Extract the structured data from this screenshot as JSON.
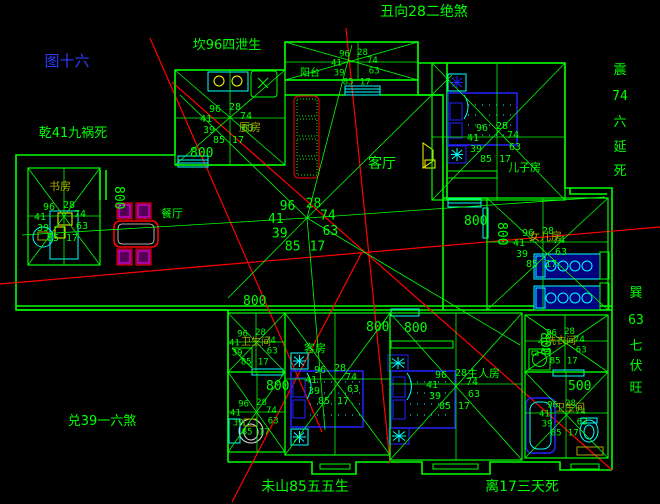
{
  "figure": {
    "label": "图十六",
    "color": "#2b3cff"
  },
  "compass": {
    "top": "丑向28二绝煞",
    "north": "坎96四泄生",
    "northwest": "乾41九祸死",
    "west": "兑39一六煞",
    "mountain": "未山85五五生",
    "south": "离17三天死",
    "east_chars": [
      "震",
      "74",
      "六",
      "延",
      "死"
    ],
    "southeast_chars": [
      "巽",
      "63",
      "七",
      "伏",
      "旺"
    ]
  },
  "stars": {
    "n1": "96",
    "n2": "28",
    "w": "41",
    "e": "74",
    "sw": "39",
    "se": "63",
    "s1": "85",
    "s2": "17"
  },
  "rooms": [
    {
      "id": "kitchen",
      "label": "厨房",
      "label_color": "olive",
      "rect": [
        175,
        70,
        110,
        95
      ],
      "center": [
        230,
        118
      ],
      "label_xy": [
        239,
        131
      ],
      "fs": 10
    },
    {
      "id": "balcony",
      "label": "阳台",
      "label_color": "green",
      "rect": [
        285,
        42,
        133,
        38
      ],
      "center": [
        358,
        62
      ],
      "label_xy": [
        300,
        76
      ],
      "fs": 9
    },
    {
      "id": "living",
      "label": "客厅",
      "label_color": "green",
      "center": [
        307,
        218
      ],
      "rays": [
        [
          180,
          95
        ],
        [
          352,
          45
        ],
        [
          452,
          75
        ],
        [
          605,
          197
        ],
        [
          520,
          345
        ],
        [
          325,
          430
        ],
        [
          228,
          298
        ],
        [
          22,
          235
        ]
      ],
      "label_xy": [
        368,
        168
      ],
      "fs": 13
    },
    {
      "id": "dining",
      "label": "餐厅",
      "label_color": "green",
      "label_xy": [
        161,
        217
      ],
      "fs": 10
    },
    {
      "id": "study",
      "label": "书房",
      "label_color": "olive",
      "rect": [
        28,
        168,
        72,
        97
      ],
      "center": [
        64,
        216
      ],
      "label_xy": [
        49,
        190
      ],
      "fs": 10
    },
    {
      "id": "son",
      "label": "儿子房",
      "label_color": "green",
      "rect": [
        432,
        63,
        133,
        137
      ],
      "center": [
        497,
        137
      ],
      "label_xy": [
        508,
        171
      ],
      "fs": 10
    },
    {
      "id": "daughter",
      "label": "女儿房",
      "label_color": "olive",
      "rect": [
        487,
        198,
        121,
        112
      ],
      "center": [
        543,
        242
      ],
      "label_xy": [
        529,
        240
      ],
      "fs": 10
    },
    {
      "id": "guest",
      "label": "客房",
      "label_color": "green",
      "rect": [
        285,
        313,
        105,
        142
      ],
      "center": [
        335,
        379
      ],
      "label_xy": [
        304,
        352
      ],
      "fs": 10
    },
    {
      "id": "master",
      "label": "主人房",
      "label_color": "green",
      "rect": [
        390,
        313,
        132,
        147
      ],
      "center": [
        456,
        384
      ],
      "label_xy": [
        467,
        377
      ],
      "fs": 10
    },
    {
      "id": "laundry",
      "label": "洗衣间",
      "label_color": "olive",
      "rect": [
        525,
        315,
        83,
        57
      ],
      "center": [
        565,
        341
      ],
      "label_xy": [
        546,
        344
      ],
      "fs": 9
    },
    {
      "id": "bath1",
      "label": "卫生间",
      "label_color": "olive",
      "rect": [
        228,
        313,
        57,
        59
      ],
      "center": [
        256,
        342
      ],
      "label_xy": [
        241,
        345
      ],
      "fs": 9
    },
    {
      "id": "bath2",
      "label": "",
      "label_color": "olive",
      "rect": [
        228,
        372,
        57,
        80
      ],
      "center": [
        257,
        412
      ],
      "fs": 9
    },
    {
      "id": "bath3",
      "label": "卫生间",
      "label_color": "olive",
      "rect": [
        525,
        372,
        83,
        86
      ],
      "center": [
        566,
        413
      ],
      "label_xy": [
        555,
        411
      ],
      "fs": 9
    }
  ],
  "dimensions": [
    {
      "t": "800",
      "x": 190,
      "y": 157,
      "r": 0
    },
    {
      "t": "800",
      "x": 115,
      "y": 186,
      "r": 90
    },
    {
      "t": "800",
      "x": 243,
      "y": 305,
      "r": 0
    },
    {
      "t": "800",
      "x": 464,
      "y": 225,
      "r": 0
    },
    {
      "t": "800",
      "x": 498,
      "y": 222,
      "r": 90
    },
    {
      "t": "800",
      "x": 366,
      "y": 331,
      "r": 0
    },
    {
      "t": "800",
      "x": 404,
      "y": 332,
      "r": 0
    },
    {
      "t": "800",
      "x": 266,
      "y": 390,
      "r": 0
    },
    {
      "t": "800",
      "x": 541,
      "y": 332,
      "r": 90
    },
    {
      "t": "500",
      "x": 568,
      "y": 390,
      "r": 0
    }
  ],
  "colors": {
    "line": "#00ff00",
    "red": "#ff0000",
    "cyan": "#00ffff",
    "blue": "#2222ff",
    "yellow": "#ffff00",
    "magenta": "#ff00ff",
    "olive": "#a8a800",
    "white": "#e0e0e0"
  }
}
